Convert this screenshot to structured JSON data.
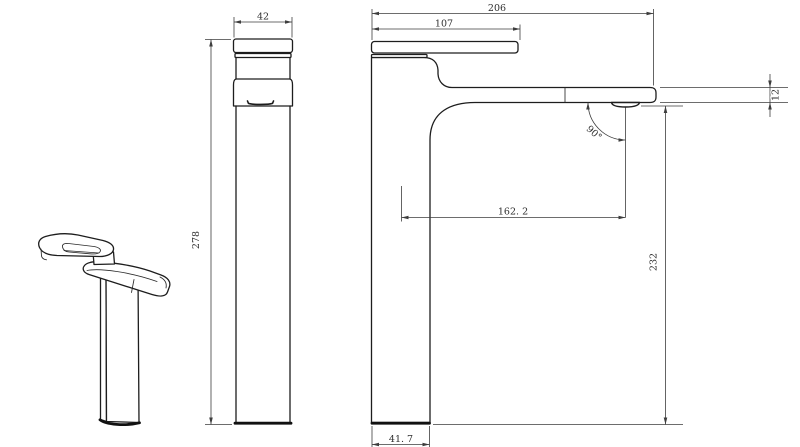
{
  "front_view": {
    "width": "42",
    "height": "278"
  },
  "side_view": {
    "overall_length": "206",
    "handle_length": "107",
    "spout_thickness": "12",
    "outlet_angle": "90°",
    "spout_reach": "162. 2",
    "outlet_height": "232",
    "base_width": "41. 7"
  },
  "colors": {
    "line": "#1d1d1d",
    "dimension": "#3d3d3d",
    "background": "#ffffff"
  }
}
